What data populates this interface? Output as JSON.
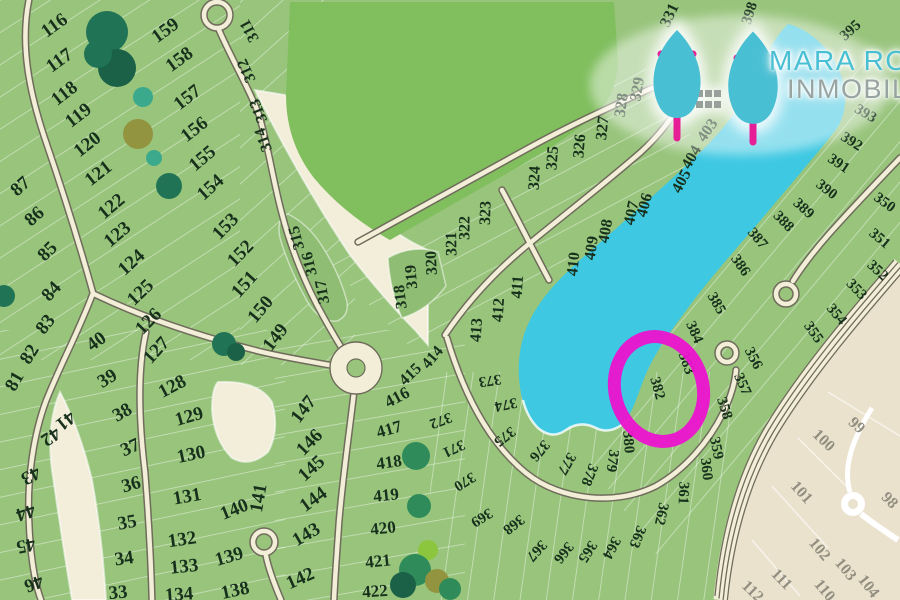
{
  "logo": {
    "line1": "MARA RO",
    "line2": "INMOBIL"
  },
  "highlight": {
    "parcel": "382"
  },
  "colors": {
    "bg": "#F2EEDA",
    "parcel": "#98C47C",
    "parcelDeep": "#8FBD73",
    "field": "#80BE5E",
    "lake": "#3EC8E2",
    "roadFill": "#F3EED7",
    "roadEdge": "#6F6C5C",
    "label": "#17301C",
    "beige": "#EBE2CE",
    "beigeLabel": "#928E80",
    "beigeRoad": "#FFFFFF",
    "highlight": "#EC13CF",
    "logoTeal": "#49BFD3",
    "logoGray": "#98A4A2",
    "logoPink": "#E61F96",
    "houseGray": "#98A09B",
    "treeDark": "#207455",
    "treeDarker": "#1A6147",
    "treeMid": "#2F8C5A",
    "treeTeal": "#3BA98C",
    "treeOlive": "#93943F",
    "treeLight": "#8CC63F"
  },
  "map": {
    "labels": [
      [
        "87",
        20,
        186,
        -42,
        19
      ],
      [
        "86",
        34,
        216,
        -42,
        19
      ],
      [
        "85",
        47,
        251,
        -45,
        19
      ],
      [
        "84",
        51,
        291,
        -48,
        19
      ],
      [
        "83",
        45,
        324,
        -52,
        19
      ],
      [
        "82",
        29,
        354,
        -58,
        19
      ],
      [
        "81",
        14,
        381,
        -60,
        19
      ],
      [
        "116",
        54,
        25,
        -36,
        19
      ],
      [
        "117",
        59,
        60,
        -36,
        19
      ],
      [
        "118",
        64,
        93,
        -38,
        19
      ],
      [
        "119",
        78,
        115,
        -38,
        19
      ],
      [
        "120",
        87,
        144,
        -38,
        19
      ],
      [
        "121",
        98,
        173,
        -38,
        19
      ],
      [
        "122",
        111,
        206,
        -40,
        19
      ],
      [
        "123",
        117,
        234,
        -40,
        19
      ],
      [
        "124",
        131,
        262,
        -42,
        19
      ],
      [
        "125",
        140,
        292,
        -44,
        19
      ],
      [
        "126",
        148,
        321,
        -46,
        19
      ],
      [
        "127",
        156,
        350,
        -48,
        19
      ],
      [
        "128",
        172,
        386,
        -28,
        19
      ],
      [
        "159",
        165,
        30,
        -36,
        19
      ],
      [
        "158",
        179,
        59,
        -36,
        19
      ],
      [
        "157",
        187,
        97,
        -38,
        19
      ],
      [
        "156",
        194,
        129,
        -38,
        19
      ],
      [
        "155",
        202,
        158,
        -40,
        19
      ],
      [
        "154",
        210,
        187,
        -42,
        19
      ],
      [
        "153",
        225,
        226,
        -46,
        19
      ],
      [
        "152",
        240,
        253,
        -46,
        19
      ],
      [
        "151",
        244,
        284,
        -48,
        19
      ],
      [
        "150",
        260,
        309,
        -50,
        19
      ],
      [
        "149",
        275,
        337,
        -52,
        19
      ],
      [
        "147",
        303,
        409,
        -52,
        19
      ],
      [
        "146",
        309,
        442,
        -46,
        19
      ],
      [
        "145",
        311,
        468,
        -42,
        19
      ],
      [
        "144",
        313,
        499,
        -36,
        19
      ],
      [
        "143",
        306,
        534,
        -30,
        19
      ],
      [
        "142",
        300,
        578,
        -24,
        19
      ],
      [
        "129",
        189,
        416,
        -16,
        19
      ],
      [
        "130",
        191,
        454,
        -12,
        19
      ],
      [
        "131",
        187,
        496,
        -10,
        19
      ],
      [
        "132",
        182,
        539,
        -8,
        19
      ],
      [
        "133",
        184,
        566,
        -6,
        19
      ],
      [
        "134",
        179,
        594,
        -4,
        19
      ],
      [
        "138",
        235,
        590,
        -12,
        19
      ],
      [
        "139",
        229,
        556,
        -16,
        19
      ],
      [
        "140",
        234,
        509,
        -22,
        19
      ],
      [
        "141",
        258,
        498,
        -80,
        19
      ],
      [
        "40",
        96,
        341,
        -36,
        19
      ],
      [
        "39",
        107,
        378,
        -32,
        19
      ],
      [
        "38",
        122,
        412,
        -30,
        19
      ],
      [
        "37",
        130,
        447,
        -24,
        19
      ],
      [
        "36",
        131,
        484,
        -16,
        19
      ],
      [
        "35",
        127,
        522,
        -10,
        19
      ],
      [
        "34",
        124,
        558,
        -8,
        19
      ],
      [
        "33",
        118,
        592,
        -5,
        19
      ],
      [
        "41",
        66,
        421,
        142,
        19
      ],
      [
        "42",
        51,
        437,
        146,
        19
      ],
      [
        "43",
        31,
        476,
        152,
        19
      ],
      [
        "44",
        26,
        513,
        162,
        19
      ],
      [
        "45",
        26,
        546,
        168,
        19
      ],
      [
        "46",
        34,
        584,
        160,
        19
      ],
      [
        "311",
        249,
        31,
        -118,
        16
      ],
      [
        "312",
        246,
        71,
        -115,
        16
      ],
      [
        "313",
        258,
        111,
        -112,
        16
      ],
      [
        "314",
        263,
        140,
        -110,
        16
      ],
      [
        "315",
        296,
        238,
        -105,
        16
      ],
      [
        "316",
        309,
        264,
        -103,
        16
      ],
      [
        "317",
        322,
        292,
        -100,
        16
      ],
      [
        "318",
        400,
        297,
        -97,
        16
      ],
      [
        "319",
        411,
        277,
        -95,
        16
      ],
      [
        "320",
        431,
        263,
        -93,
        16
      ],
      [
        "321",
        451,
        244,
        -91,
        16
      ],
      [
        "322",
        464,
        228,
        -90,
        16
      ],
      [
        "323",
        485,
        213,
        -88,
        16
      ],
      [
        "324",
        534,
        178,
        -87,
        16
      ],
      [
        "325",
        552,
        158,
        -86,
        16
      ],
      [
        "326",
        579,
        146,
        -85,
        16
      ],
      [
        "327",
        602,
        128,
        -84,
        16
      ],
      [
        "328",
        621,
        105,
        -82,
        16
      ],
      [
        "329",
        637,
        89,
        -80,
        16
      ],
      [
        "331",
        669,
        15,
        -65,
        16
      ],
      [
        "403",
        707,
        130,
        -55,
        16
      ],
      [
        "404",
        691,
        157,
        -60,
        16
      ],
      [
        "405",
        681,
        181,
        -62,
        16
      ],
      [
        "406",
        644,
        205,
        -75,
        16
      ],
      [
        "407",
        631,
        213,
        -78,
        16
      ],
      [
        "408",
        605,
        231,
        -80,
        16
      ],
      [
        "409",
        591,
        248,
        -82,
        16
      ],
      [
        "410",
        573,
        264,
        -84,
        16
      ],
      [
        "411",
        517,
        287,
        -86,
        16
      ],
      [
        "412",
        498,
        310,
        -86,
        16
      ],
      [
        "413",
        476,
        330,
        -86,
        16
      ],
      [
        "414",
        432,
        357,
        -50,
        16
      ],
      [
        "415",
        410,
        374,
        -44,
        16
      ],
      [
        "416",
        397,
        397,
        -28,
        17
      ],
      [
        "417",
        389,
        429,
        -16,
        17
      ],
      [
        "418",
        389,
        462,
        -8,
        17
      ],
      [
        "419",
        386,
        495,
        -6,
        17
      ],
      [
        "420",
        383,
        528,
        -6,
        17
      ],
      [
        "421",
        378,
        561,
        -6,
        17
      ],
      [
        "422",
        375,
        591,
        -4,
        17
      ],
      [
        "372",
        441,
        421,
        160,
        15
      ],
      [
        "371",
        454,
        449,
        155,
        15
      ],
      [
        "370",
        465,
        482,
        148,
        15
      ],
      [
        "373",
        490,
        381,
        172,
        15
      ],
      [
        "374",
        506,
        405,
        168,
        15
      ],
      [
        "375",
        505,
        437,
        142,
        15
      ],
      [
        "376",
        540,
        451,
        130,
        15
      ],
      [
        "377",
        567,
        464,
        120,
        15
      ],
      [
        "378",
        590,
        475,
        112,
        15
      ],
      [
        "379",
        613,
        461,
        98,
        15
      ],
      [
        "380",
        629,
        442,
        86,
        15
      ],
      [
        "382",
        658,
        388,
        74,
        15
      ],
      [
        "383",
        687,
        363,
        70,
        15
      ],
      [
        "384",
        695,
        332,
        66,
        15
      ],
      [
        "385",
        717,
        303,
        60,
        15
      ],
      [
        "386",
        741,
        265,
        55,
        15
      ],
      [
        "387",
        758,
        238,
        50,
        15
      ],
      [
        "388",
        784,
        221,
        46,
        15
      ],
      [
        "389",
        804,
        208,
        42,
        15
      ],
      [
        "390",
        827,
        189,
        38,
        15
      ],
      [
        "391",
        839,
        163,
        34,
        15
      ],
      [
        "392",
        852,
        141,
        32,
        15
      ],
      [
        "393",
        866,
        113,
        30,
        15
      ],
      [
        "395",
        850,
        30,
        -42,
        15
      ],
      [
        "398",
        749,
        13,
        -72,
        15
      ],
      [
        "350",
        885,
        202,
        36,
        15
      ],
      [
        "351",
        880,
        238,
        40,
        15
      ],
      [
        "352",
        878,
        270,
        42,
        15
      ],
      [
        "353",
        857,
        289,
        46,
        15
      ],
      [
        "354",
        837,
        314,
        50,
        15
      ],
      [
        "355",
        814,
        332,
        55,
        15
      ],
      [
        "356",
        754,
        358,
        62,
        15
      ],
      [
        "357",
        743,
        384,
        66,
        15
      ],
      [
        "358",
        725,
        408,
        72,
        15
      ],
      [
        "359",
        717,
        448,
        78,
        15
      ],
      [
        "360",
        707,
        469,
        84,
        15
      ],
      [
        "361",
        684,
        493,
        92,
        15
      ],
      [
        "362",
        662,
        514,
        102,
        15
      ],
      [
        "363",
        638,
        537,
        112,
        15
      ],
      [
        "364",
        612,
        548,
        118,
        15
      ],
      [
        "365",
        588,
        552,
        122,
        15
      ],
      [
        "366",
        564,
        553,
        128,
        15
      ],
      [
        "367",
        537,
        551,
        132,
        15
      ],
      [
        "368",
        514,
        525,
        142,
        15
      ],
      [
        "369",
        482,
        518,
        148,
        15
      ],
      [
        "99",
        857,
        425,
        42,
        16,
        "f"
      ],
      [
        "100",
        824,
        440,
        44,
        16,
        "f"
      ],
      [
        "101",
        802,
        492,
        48,
        16,
        "f"
      ],
      [
        "102",
        820,
        549,
        50,
        16,
        "f"
      ],
      [
        "103",
        846,
        569,
        50,
        16,
        "f"
      ],
      [
        "104",
        869,
        586,
        52,
        16,
        "f"
      ],
      [
        "98",
        890,
        500,
        46,
        16,
        "f"
      ],
      [
        "110",
        825,
        590,
        50,
        16,
        "f"
      ],
      [
        "111",
        782,
        579,
        46,
        16,
        "f"
      ],
      [
        "112",
        753,
        591,
        44,
        16,
        "f"
      ]
    ]
  }
}
